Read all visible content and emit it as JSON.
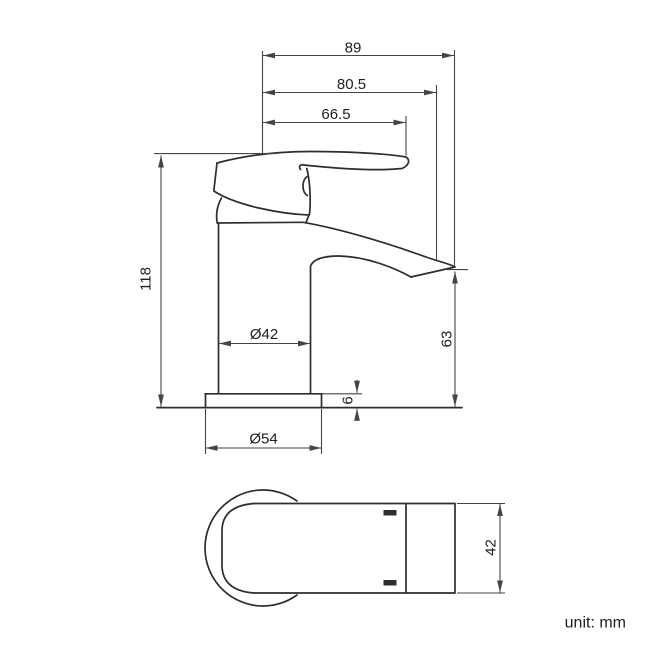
{
  "drawing": {
    "title": "basin tap dimensional drawing",
    "unit_label": "unit: mm",
    "colors": {
      "object_line": "#2d2d2d",
      "dimension_line": "#454545",
      "text": "#202020",
      "background": "#ffffff"
    },
    "side_view": {
      "total_reach": "89",
      "outlet_reach": "80.5",
      "handle_reach": "66.5",
      "total_height": "118",
      "outlet_height": "63",
      "body_diameter": "Ø42",
      "base_thickness": "6",
      "base_diameter": "Ø54"
    },
    "plan_view": {
      "end_width": "42"
    }
  }
}
